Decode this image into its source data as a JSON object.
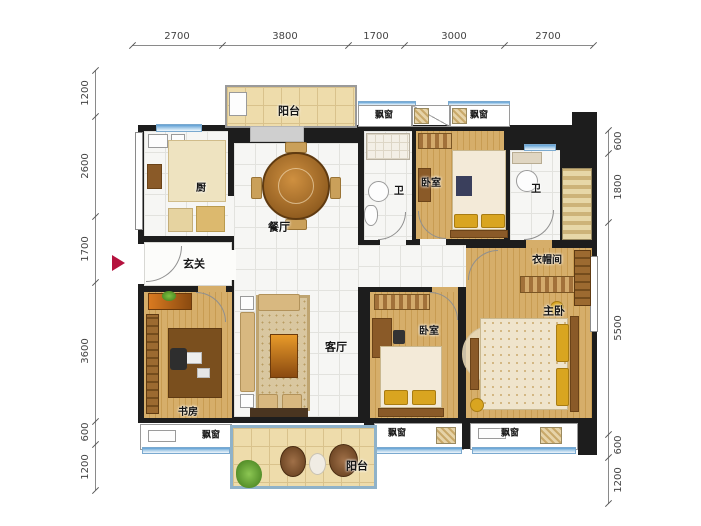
{
  "title": "apartment-floor-plan",
  "dimensions": {
    "top": [
      "2700",
      "3800",
      "1700",
      "3000",
      "2700"
    ],
    "left": [
      "1200",
      "2600",
      "1700",
      "3600",
      "600",
      "1200"
    ],
    "right": [
      "600",
      "1800",
      "5500",
      "600",
      "1200"
    ]
  },
  "rooms": {
    "balcony_top": "阳台",
    "kitchen": "厨",
    "dining": "餐厅",
    "bath1": "卫",
    "bedroom_top": "卧室",
    "bath2": "卫",
    "entry": "玄关",
    "cloakroom": "衣帽间",
    "master_bedroom": "主卧",
    "living": "客厅",
    "bedroom2": "卧室",
    "study": "书房",
    "balcony_bottom": "阳台"
  },
  "labels": {
    "bay_window": "飘窗"
  },
  "colors": {
    "wall": "#1d1d1d",
    "wood_floor": "#d0a65f",
    "tile_floor": "#f6f6f4",
    "balcony_floor": "#eedcab",
    "window_sill_blue": "#5e9fd4",
    "entrance_arrow": "#b5123e"
  }
}
